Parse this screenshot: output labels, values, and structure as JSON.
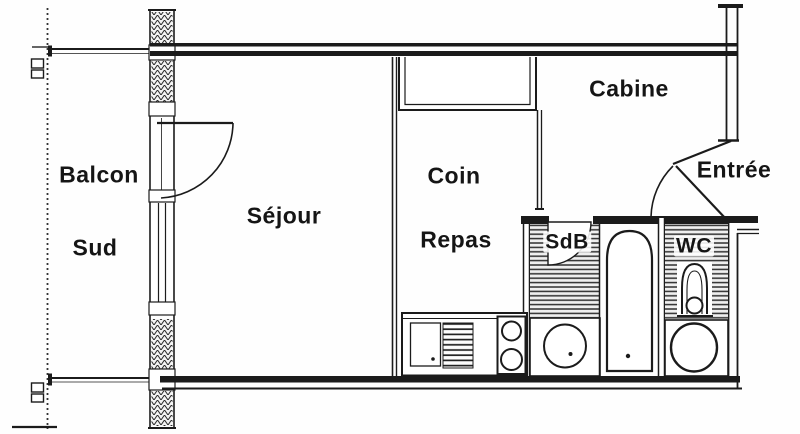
{
  "palette": {
    "ink": "#1b1b1b",
    "paper": "#ffffff",
    "floor_stripe": "#2f2f2f"
  },
  "rooms": {
    "balcon": {
      "label": "Balcon"
    },
    "sud": {
      "label": "Sud"
    },
    "sejour": {
      "label": "Séjour"
    },
    "coin": {
      "label": "Coin"
    },
    "repas": {
      "label": "Repas"
    },
    "cabine": {
      "label": "Cabine"
    },
    "entree": {
      "label": "Entrée"
    },
    "sdb": {
      "label": "SdB"
    },
    "wc": {
      "label": "WC"
    }
  }
}
